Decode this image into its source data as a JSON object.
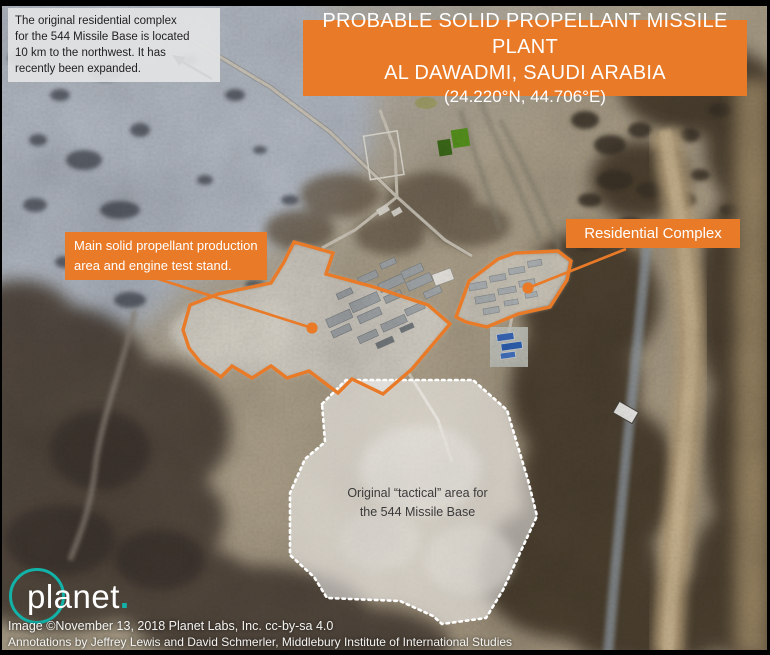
{
  "colors": {
    "annotation_orange": "#E87A28",
    "planet_teal": "#12B2A8",
    "note_box_bg": "#E2E3E4",
    "note_text": "#1F1F1F",
    "label_text": "#FFFFFF",
    "tactical_fill_white_opacity": "0.52",
    "tactical_text": "#3B3B3B",
    "arrow_black": "#111111"
  },
  "title_banner": {
    "line1": "PROBABLE SOLID PROPELLANT MISSILE PLANT",
    "line2": "AL DAWADMI, SAUDI ARABIA",
    "line3": "(24.220°N, 44.706°E)"
  },
  "note_box": {
    "lines": [
      "The original residential complex",
      "for the 544 Missile Base is located",
      "10 km to the northwest. It has",
      "recently been expanded."
    ]
  },
  "annotations": {
    "production_label": {
      "lines": [
        "Main solid propellant production",
        "area and engine test stand."
      ]
    },
    "residential_label": {
      "text": "Residential Complex"
    },
    "tactical_label": {
      "lines": [
        "Original “tactical” area for",
        "the 544 Missile Base"
      ]
    }
  },
  "logo": {
    "wordmark": "planet",
    "dot": "."
  },
  "credits": {
    "line1": "Image ©November 13, 2018 Planet Labs, Inc. cc-by-sa 4.0",
    "line2": "Annotations by Jeffrey Lewis and David Schmerler, Middlebury Institute of International Studies"
  }
}
